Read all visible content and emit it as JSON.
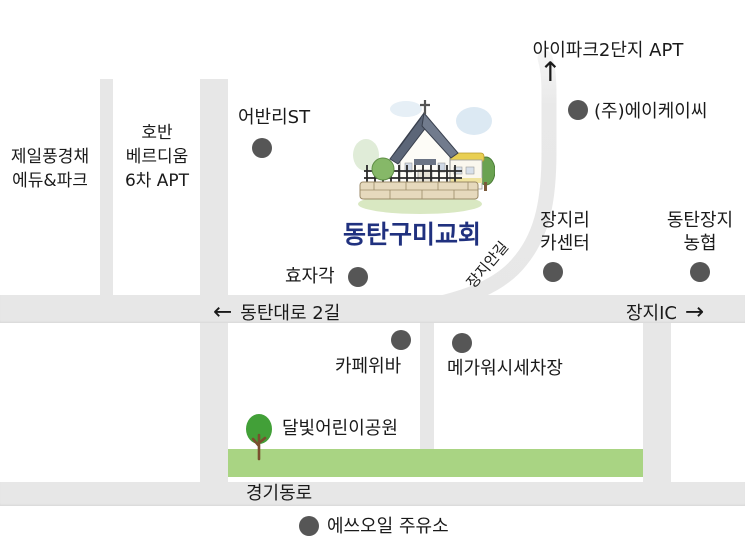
{
  "labels": {
    "jeil_line1": "제일풍경채",
    "jeil_line2": "에듀&파크",
    "hoban_line1": "호반",
    "hoban_line2": "베르디움",
    "hoban_line3": "6차 APT",
    "urbanli": "어반리ST",
    "ipark": "아이파크2단지 APT",
    "akc": "(주)에이케이씨",
    "church": "동탄구미교회",
    "jangjiangil": "장지안길",
    "jangjiri_line1": "장지리",
    "jangjiri_line2": "카센터",
    "nonghyup_line1": "동탄장지",
    "nonghyup_line2": "농협",
    "hyojagak": "효자각",
    "dongtandaero": "동탄대로 2길",
    "jangji_ic": "장지IC",
    "cafe": "카페위바",
    "megawash": "메가워시세차장",
    "park": "달빛어린이공원",
    "gyeonggidongro": "경기동로",
    "soil": "에쓰오일 주유소"
  },
  "arrows": {
    "left": "←",
    "right": "→",
    "up": "↑"
  },
  "colors": {
    "road": "#e7e7e7",
    "park_green": "#a9d483",
    "dot": "#565656",
    "text": "#1a1a1a",
    "church_text": "#20317f"
  }
}
